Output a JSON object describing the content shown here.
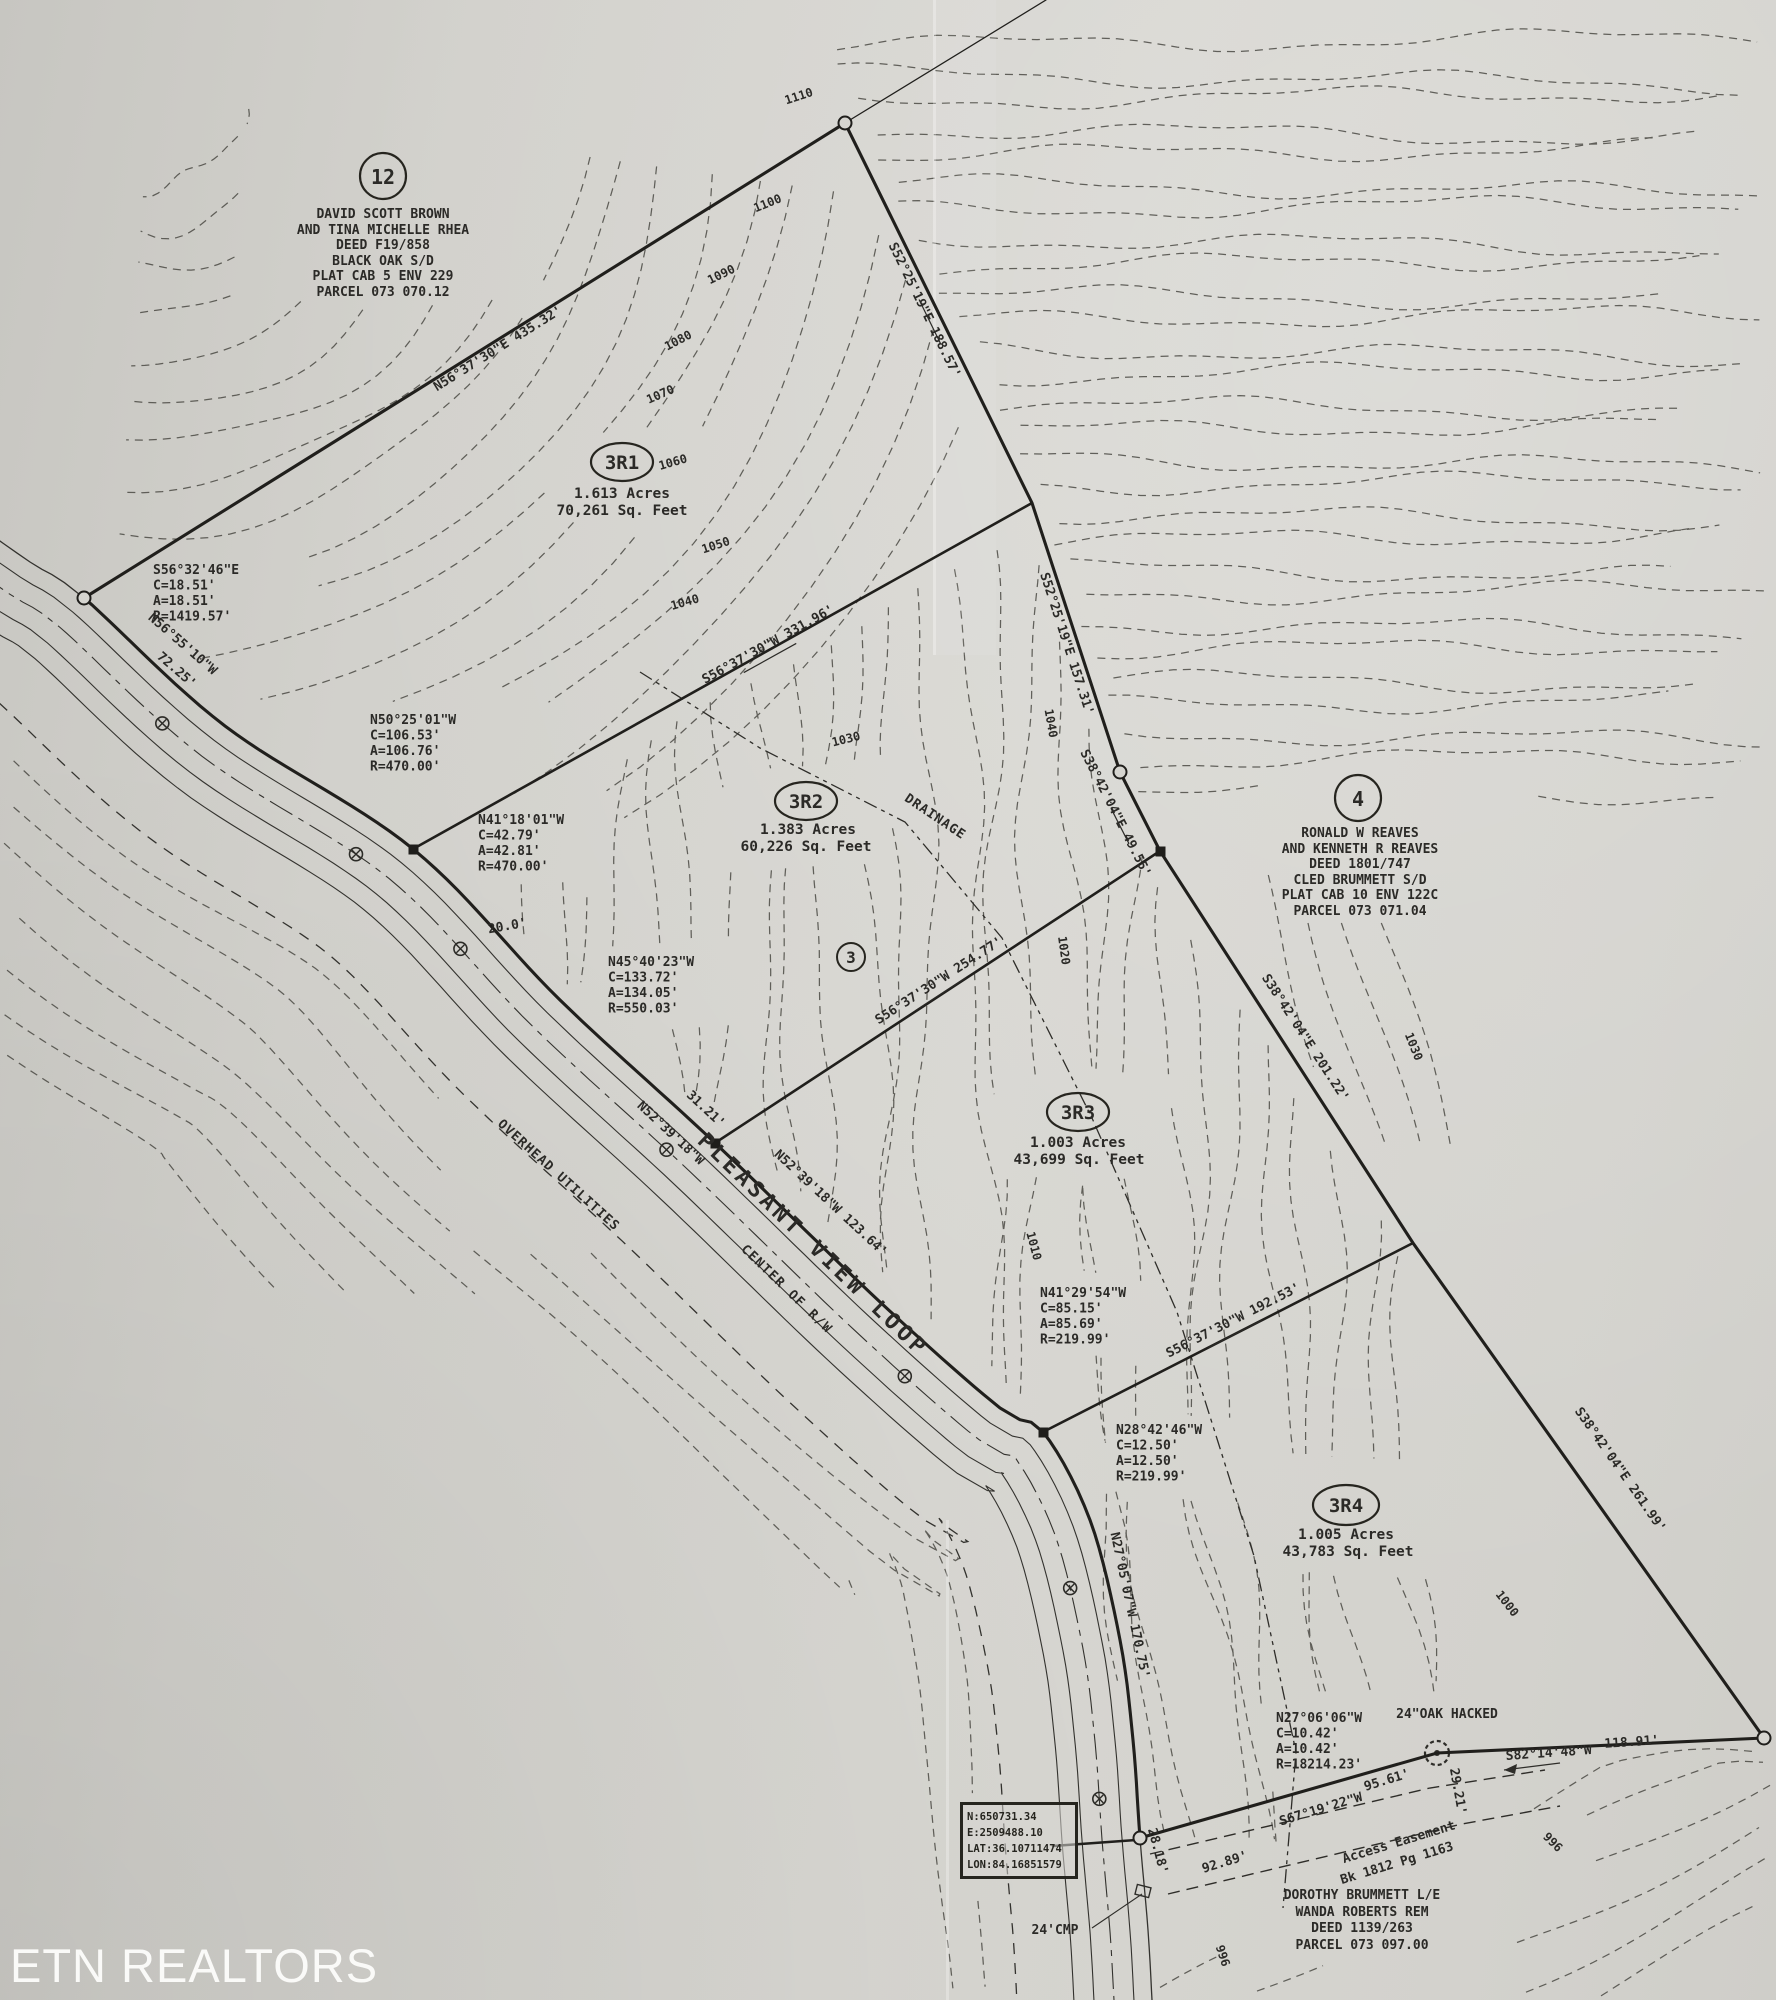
{
  "watermark": "ETN REALTORS",
  "parcels": [
    {
      "id": "3R1",
      "area_acres": "1.613 Acres",
      "area_sqft": "70,261 Sq. Feet"
    },
    {
      "id": "3R2",
      "area_acres": "1.383 Acres",
      "area_sqft": "60,226 Sq. Feet"
    },
    {
      "id": "3R3",
      "area_acres": "1.003 Acres",
      "area_sqft": "43,699 Sq. Feet"
    },
    {
      "id": "3R4",
      "area_acres": "1.005 Acres",
      "area_sqft": "43,783 Sq. Feet"
    },
    {
      "id": "3",
      "area_acres": "",
      "area_sqft": ""
    }
  ],
  "adjoining_owners": [
    {
      "number": "12",
      "lines": [
        "DAVID SCOTT BROWN",
        "AND TINA MICHELLE RHEA",
        "DEED F19/858",
        "BLACK OAK S/D",
        "PLAT CAB 5 ENV 229",
        "PARCEL 073 070.12"
      ]
    },
    {
      "number": "4",
      "lines": [
        "RONALD W REAVES",
        "AND KENNETH R REAVES",
        "DEED 1801/747",
        "CLED BRUMMETT S/D",
        "PLAT CAB 10 ENV 122C",
        "PARCEL 073 071.04"
      ]
    },
    {
      "number": "",
      "lines": [
        "DOROTHY BRUMMETT L/E",
        "WANDA ROBERTS REM",
        "DEED 1139/263",
        "PARCEL 073 097.00"
      ]
    }
  ],
  "curve_tables": [
    {
      "lines": [
        "S56°32'46\"E",
        "C=18.51'",
        "A=18.51'",
        "R=1419.57'"
      ]
    },
    {
      "lines": [
        "N50°25'01\"W",
        "C=106.53'",
        "A=106.76'",
        "R=470.00'"
      ]
    },
    {
      "lines": [
        "N41°18'01\"W",
        "C=42.79'",
        "A=42.81'",
        "R=470.00'"
      ]
    },
    {
      "lines": [
        "N45°40'23\"W",
        "C=133.72'",
        "A=134.05'",
        "R=550.03'"
      ]
    },
    {
      "lines": [
        "N41°29'54\"W",
        "C=85.15'",
        "A=85.69'",
        "R=219.99'"
      ]
    },
    {
      "lines": [
        "N28°42'46\"W",
        "C=12.50'",
        "A=12.50'",
        "R=219.99'"
      ]
    },
    {
      "lines": [
        "N27°06'06\"W",
        "C=10.42'",
        "A=10.42'",
        "R=18214.23'"
      ]
    }
  ],
  "bearing_labels": [
    "N56°37'30\"E  435.32'",
    "S52°25'19\"E  188.57'",
    "S52°25'19\"E  157.31'",
    "S38°42'04\"E  49.55'",
    "S38°42'04\"E  201.22'",
    "S38°42'04\"E  261.99'",
    "S56°37'30\"W  331.96'",
    "S56°37'30\"W  254.77'",
    "S56°37'30\"W  192.53'",
    "N52°39'18\"W",
    "31.21'",
    "N52°39'18\"W  123.64'",
    "N27°05'07\"W  170.75'",
    "N56°55'10\"W",
    "72.25'",
    "S67°19'22\"W",
    "95.61'",
    "S82°14'48\"W",
    "118.91'",
    "92.89'",
    "28.18'",
    "29.21'",
    "20.0'",
    "24\"OAK HACKED",
    "24'CMP"
  ],
  "road_labels": {
    "road_name": "PLEASANT VIEW LOOP",
    "centerline": "CENTER OF R/W",
    "utilities": "OVERHEAD UTILITIES",
    "drainage": "DRAINAGE"
  },
  "easement_label": [
    "Access Easement",
    "Bk 1812 Pg 1163"
  ],
  "coordinate_box": [
    "N:650731.34",
    "E:2509488.10",
    "LAT:36.10711474",
    "LON:84.16851579"
  ],
  "contour_labels": [
    "1110",
    "1100",
    "1090",
    "1080",
    "1070",
    "1060",
    "1050",
    "1040",
    "1030",
    "1040",
    "1020",
    "1010",
    "1030",
    "1000",
    "996",
    "996"
  ]
}
